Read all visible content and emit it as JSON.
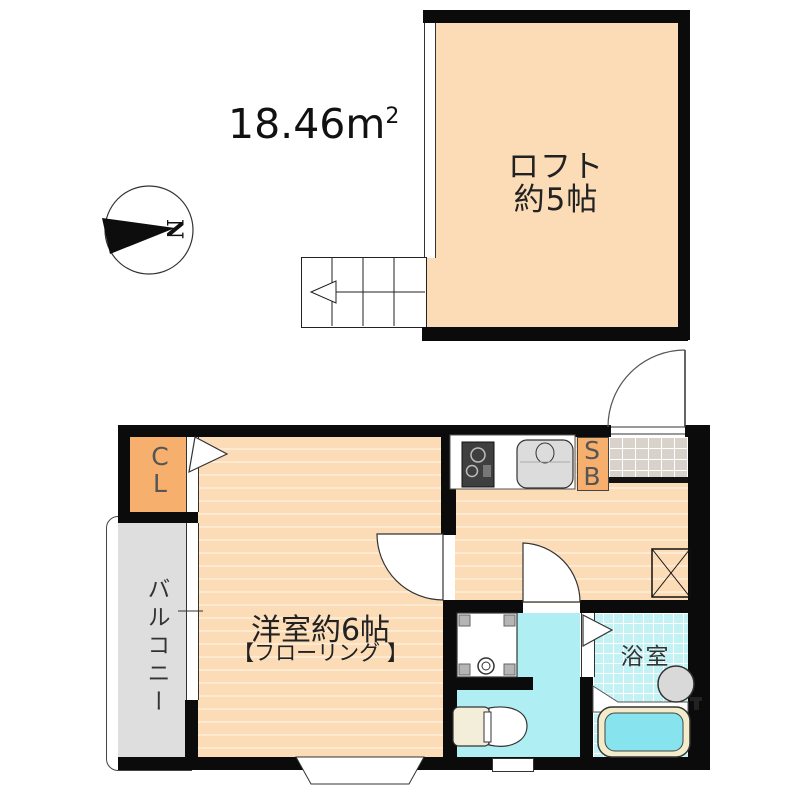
{
  "area": {
    "value": "18.46",
    "unit": "m",
    "superscript": "2"
  },
  "compass": {
    "letter": "N"
  },
  "rooms": {
    "loft": {
      "name": "ロフト",
      "size": "約5帖"
    },
    "main_room": {
      "name": "洋室約6帖",
      "finish": "【フローリング 】"
    },
    "bathroom": {
      "name": "浴室"
    },
    "balcony": {
      "name": "バルコニー"
    },
    "closet": {
      "line1": "C",
      "line2": "L"
    },
    "shoe_box": {
      "line1": "S",
      "line2": "B"
    }
  },
  "colors": {
    "floor_peach": "#FBDCB6",
    "floor_stripe": "#FDEAD1",
    "closet_orange": "#F6AF6C",
    "balcony_gray": "#DEDEDE",
    "washroom_cyan": "#AFEFF3",
    "bathroom_cyan": "#C3F2F5",
    "bathtub_cyan": "#87E3ED",
    "tub_rim_cream": "#F2ECCB",
    "entrance_tile": "#D9D2CA",
    "wall_black": "#0B0B0B"
  }
}
